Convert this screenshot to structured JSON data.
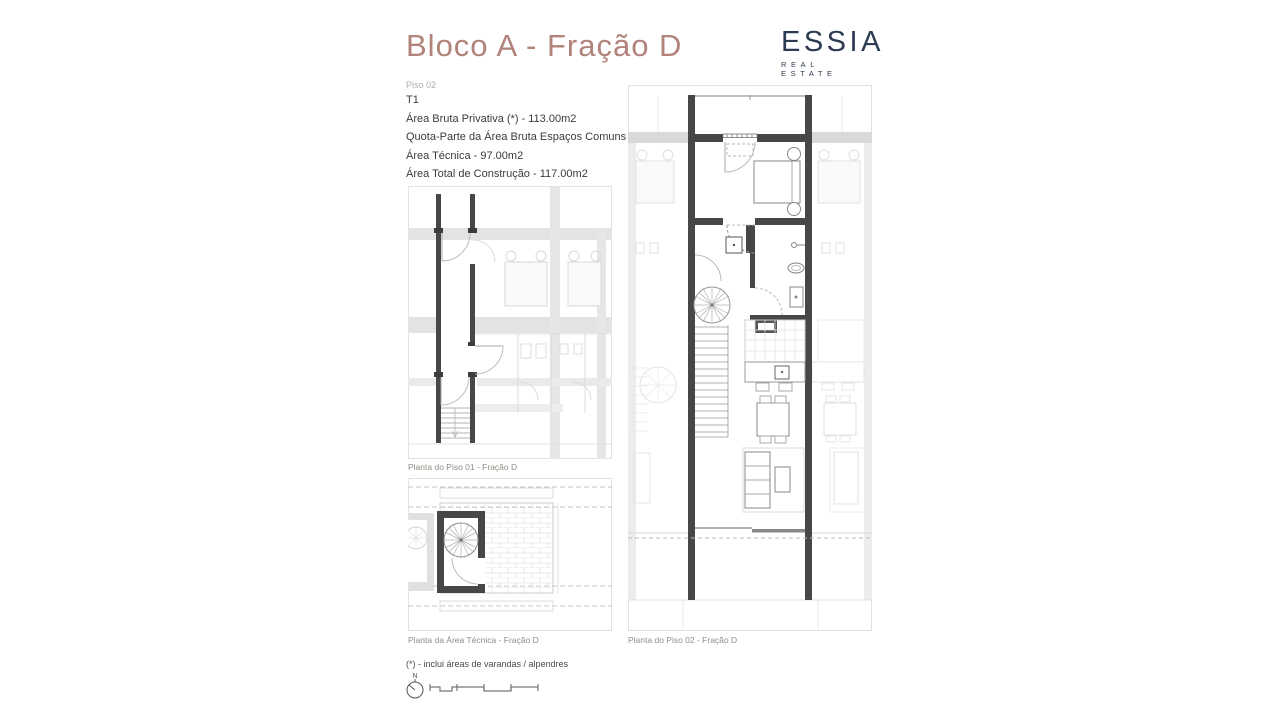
{
  "header": {
    "title": "Bloco A - Fração D",
    "logo": {
      "name": "ESSIA",
      "tagline": "REAL ESTATE"
    }
  },
  "info": {
    "floor_label": "Piso 02",
    "typology": "T1",
    "lines": [
      "Área Bruta Privativa (*) - 113.00m2",
      "Quota-Parte da Área Bruta Espaços Comuns - 4.00m2",
      "Área Técnica - 97.00m2",
      "Área Total de Construção - 117.00m2"
    ]
  },
  "plans": [
    {
      "id": "piso01",
      "caption": "Planta do Piso 01 - Fração D"
    },
    {
      "id": "area-tecnica",
      "caption": "Planta da Área Técnica - Fração D"
    },
    {
      "id": "piso02",
      "caption": "Planta do Piso 02 - Fração D"
    }
  ],
  "footer": {
    "footnote": "(*) - inclui áreas de varandas / alpendres",
    "north_label": "N"
  },
  "colors": {
    "title_rose": "#b1837a",
    "logo_navy": "#2c3b52",
    "wall_dark": "#474747",
    "faded_gray": "#dcdcdc",
    "caption_gray": "#8f8d85"
  }
}
